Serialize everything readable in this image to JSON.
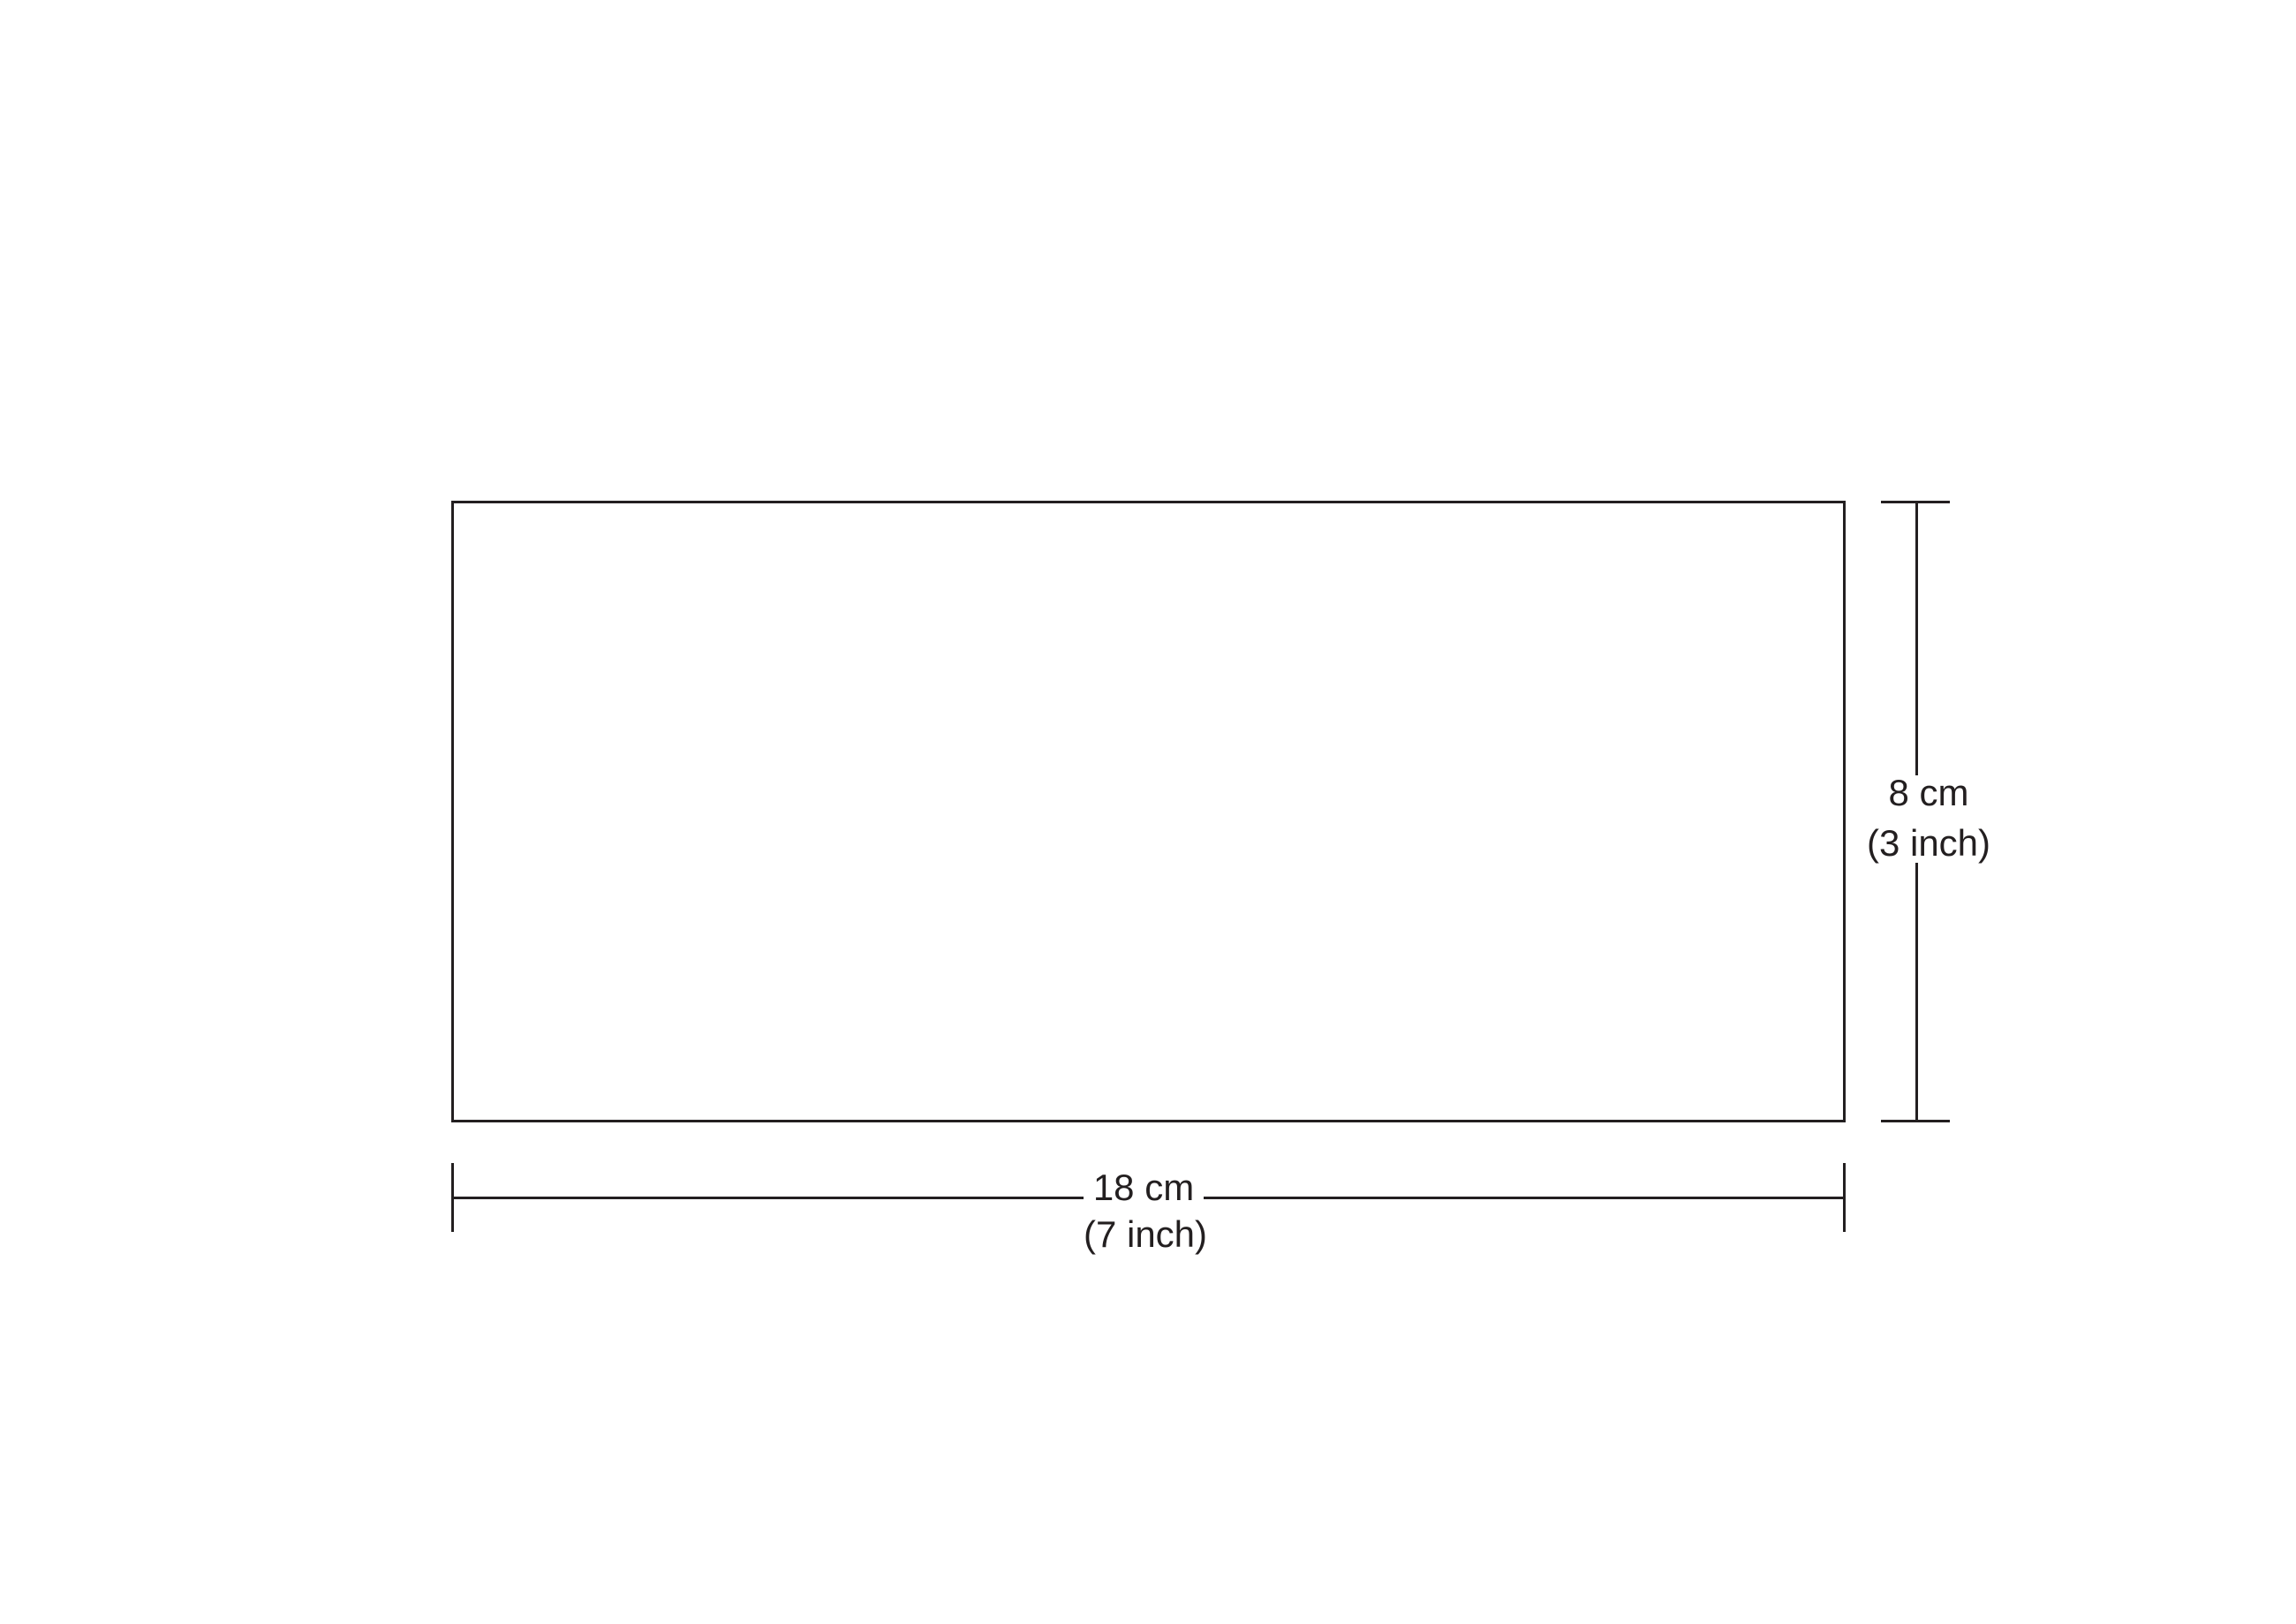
{
  "theme": {
    "ink": "#231f20",
    "bg": "#ffffff"
  },
  "diagram": {
    "shape": "rectangle",
    "width_dimension": {
      "metric": "18 cm",
      "imperial": "(7 inch)"
    },
    "height_dimension": {
      "metric": "8 cm",
      "imperial": "(3 inch)"
    }
  }
}
